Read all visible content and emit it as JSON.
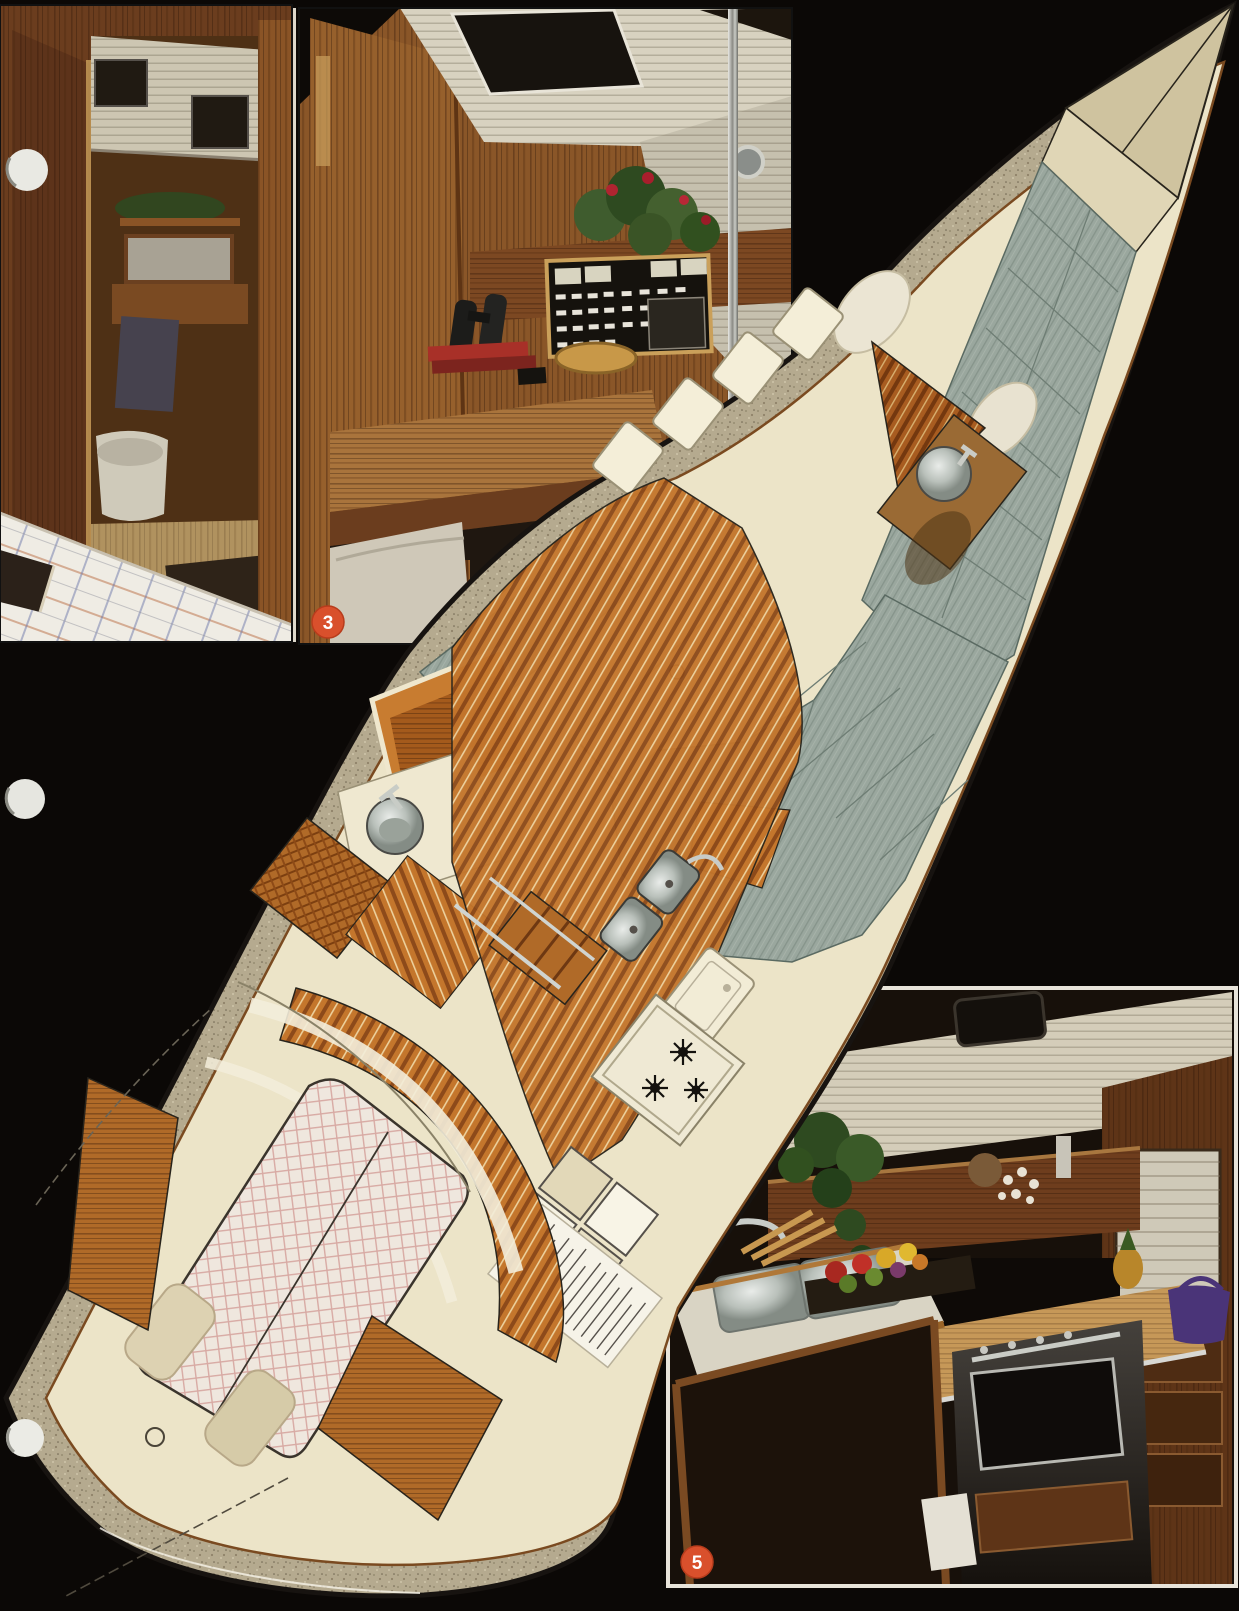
{
  "page": {
    "background_color": "#0b0806",
    "kind": "sailboat brochure page with interior cutaway illustration and photo insets"
  },
  "badges": [
    {
      "label": "3",
      "color": "#d9502c"
    },
    {
      "label": "5",
      "color": "#d9502c"
    }
  ],
  "figures": {
    "photo_head_cabin": "photo of teak doorway into head compartment with quilted berth in foreground",
    "photo_nav_station": "photo of navigation station with electrical panel, plant and chart table",
    "photo_galley": "photo of galley with stainless sink, stove, oven and teak cabinetry",
    "illustration": "perspective cutaway drawing of yacht interior from bow to stern"
  },
  "hole_punches": {
    "count": 3
  },
  "colors": {
    "hull_cream": "#ece4c8",
    "deck_speckle": "#b5aa8f",
    "teak_sole": "#c4762c",
    "cushion_gray_green": "#9aa79e",
    "badge_red": "#d9502c",
    "wood_dark": "#6b3d1e",
    "wood_mid": "#8a5628",
    "ceiling_white": "#d6d0bc"
  }
}
